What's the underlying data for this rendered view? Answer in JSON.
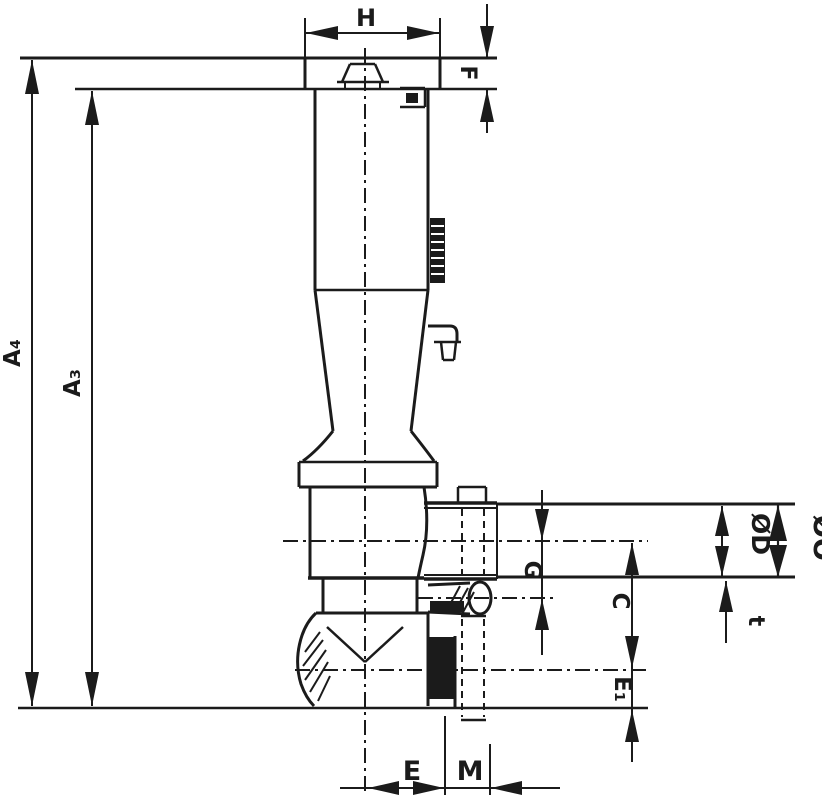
{
  "drawing": {
    "type": "technical-dimension-drawing",
    "subject": "valve-tap-outline-with-dimensions",
    "colors": {
      "line": "#1b1b1b",
      "background": "#ffffff"
    },
    "labels": {
      "h": "H",
      "f": "F",
      "a4": "A₄",
      "a3": "A₃",
      "od": "ØD",
      "oo": "ØO",
      "g": "G",
      "c": "C",
      "t": "t",
      "e1": "E₁",
      "e": "E",
      "m": "M"
    }
  }
}
